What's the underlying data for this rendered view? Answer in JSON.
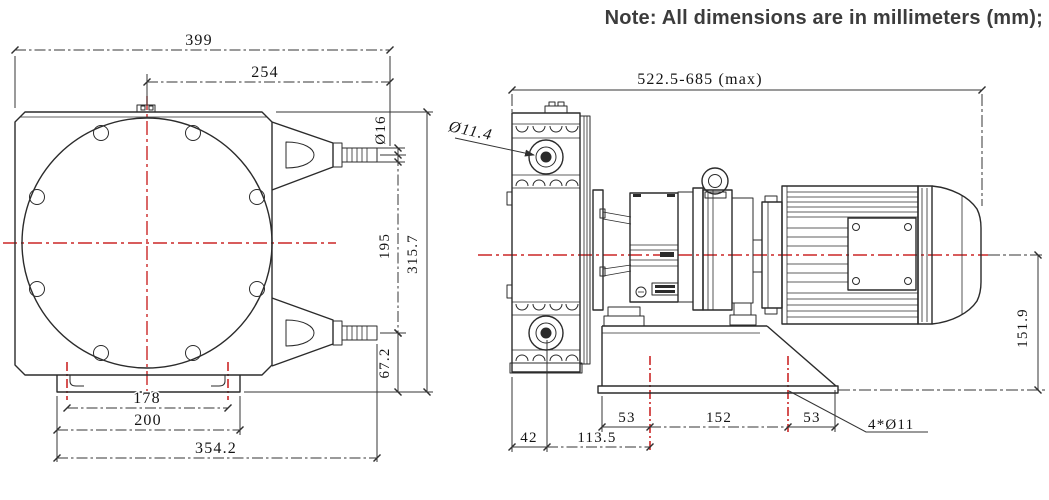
{
  "note": "Note: All dimensions are in millimeters (mm);",
  "colors": {
    "line": "#2b2b2b",
    "dimension": "#343434",
    "centerline_red": "#cb2727"
  },
  "front_view": {
    "dim_overall_width": "399",
    "dim_center_to_edge": "254",
    "dim_barb_diameter": "Ø16",
    "dim_port_spacing": "195",
    "dim_overall_height": "315.7",
    "dim_port_to_base": "67.2",
    "dim_foot_hole_spacing": "178",
    "dim_foot_width": "200",
    "dim_overall_depth": "354.2"
  },
  "side_view": {
    "dim_overall_length": "522.5-685 (max)",
    "dim_port_bore": "Ø11.4",
    "dim_center_height": "151.9",
    "dim_hole_offset_left": "53",
    "dim_hole_spacing": "152",
    "dim_hole_offset_right": "53",
    "dim_face_to_port": "42",
    "dim_port_to_hole": "113.5",
    "dim_mount_holes": "4*Ø11"
  }
}
